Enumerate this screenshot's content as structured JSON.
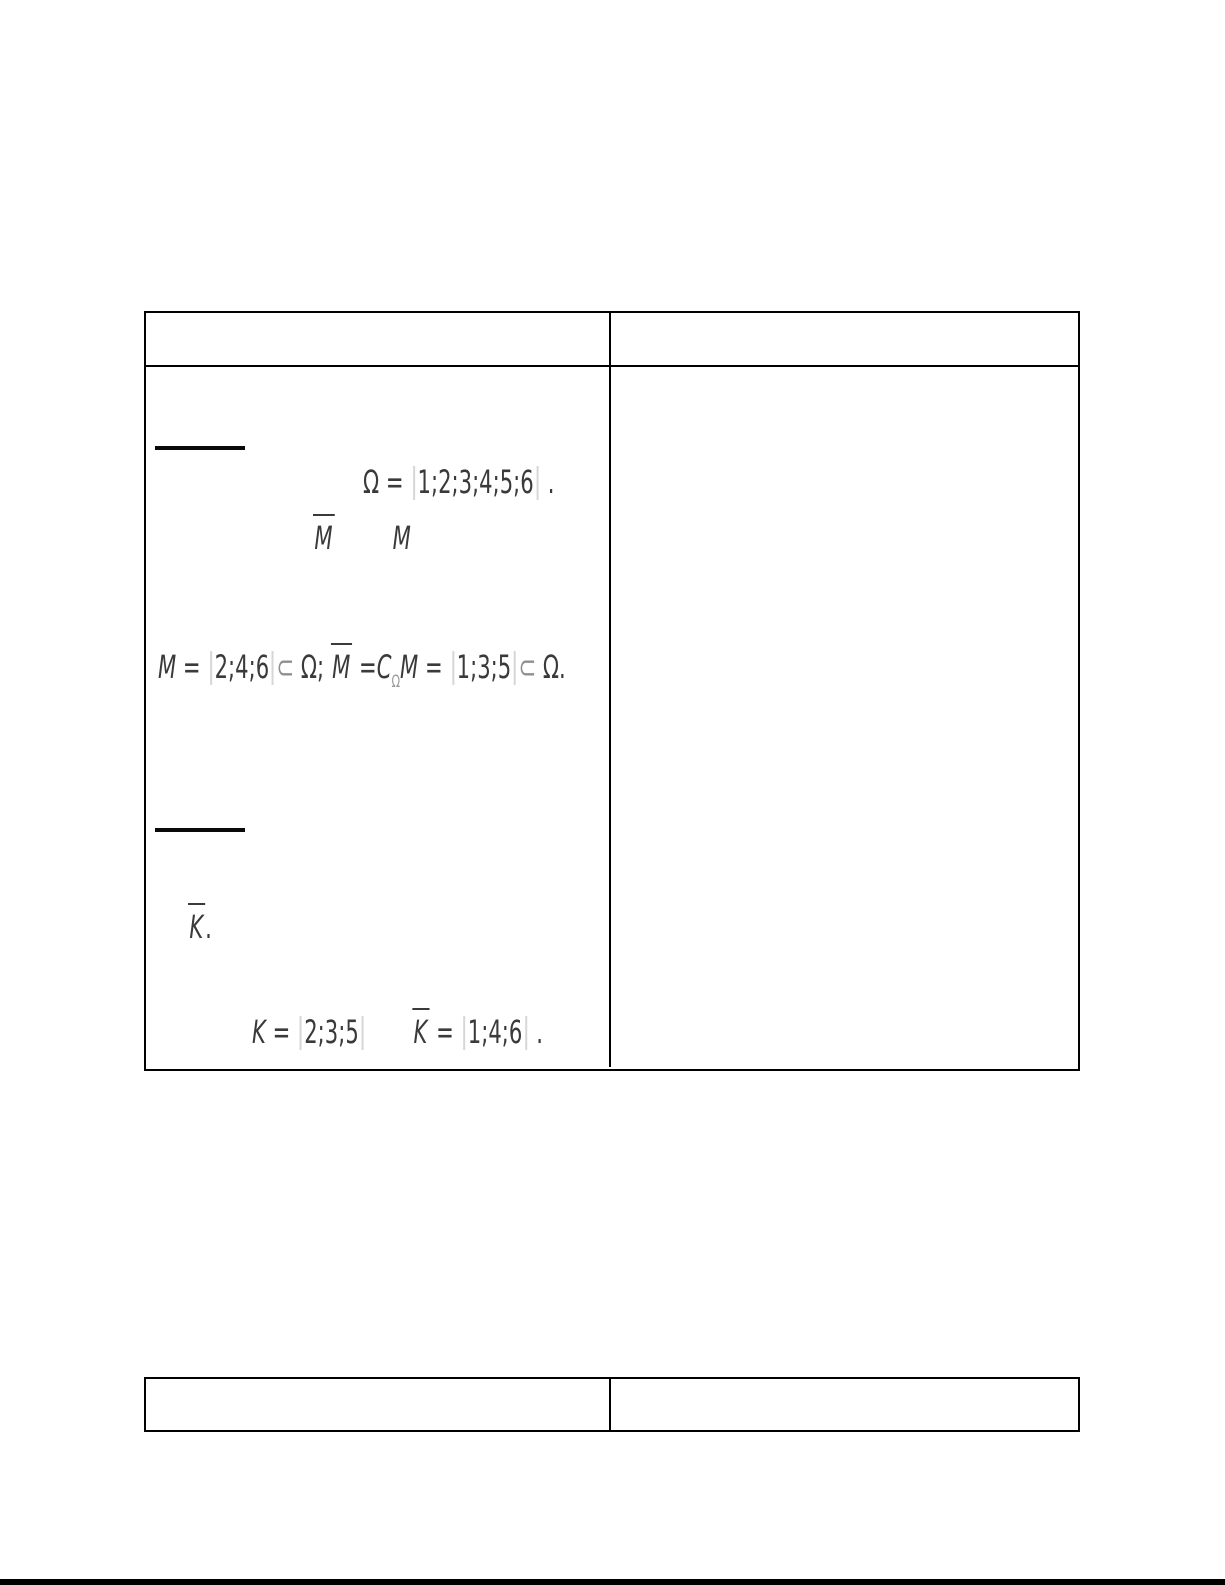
{
  "main_table": {
    "header_left": "",
    "header_right": "",
    "solution": {
      "omega_formula": {
        "sym": "Ω",
        "eq": " = ",
        "set": "1;2;3;4;5;6",
        "tail": " ."
      },
      "complement_pair": {
        "mbar": "M",
        "m": "M"
      },
      "m_formula": {
        "m1": "M",
        "eq1": " = ",
        "set1": "2;4;6",
        "subset1": "⊂",
        "omega1": " Ω; ",
        "mbar": "M",
        "eq2": " =",
        "c": "C",
        "c_sub": "Ω",
        "m2": "M",
        "eq3": " = ",
        "set2": "1;3;5",
        "subset2": "⊂",
        "omega2": " Ω."
      },
      "kbar_line": {
        "kbar": "K",
        "tail": "."
      },
      "k_formula": {
        "k": "K",
        "eq1": " = ",
        "set1": "2;3;5",
        "kbar": "K",
        "eq2": " = ",
        "set2": "1;4;6",
        "tail": " ."
      }
    }
  },
  "secondary_table": {
    "header_left": "",
    "header_right": ""
  },
  "colors": {
    "text": "#3a3a3a",
    "subset_muted": "#8f8f8f",
    "brace_bar": "#d6d6d6",
    "table_border": "#000000"
  }
}
